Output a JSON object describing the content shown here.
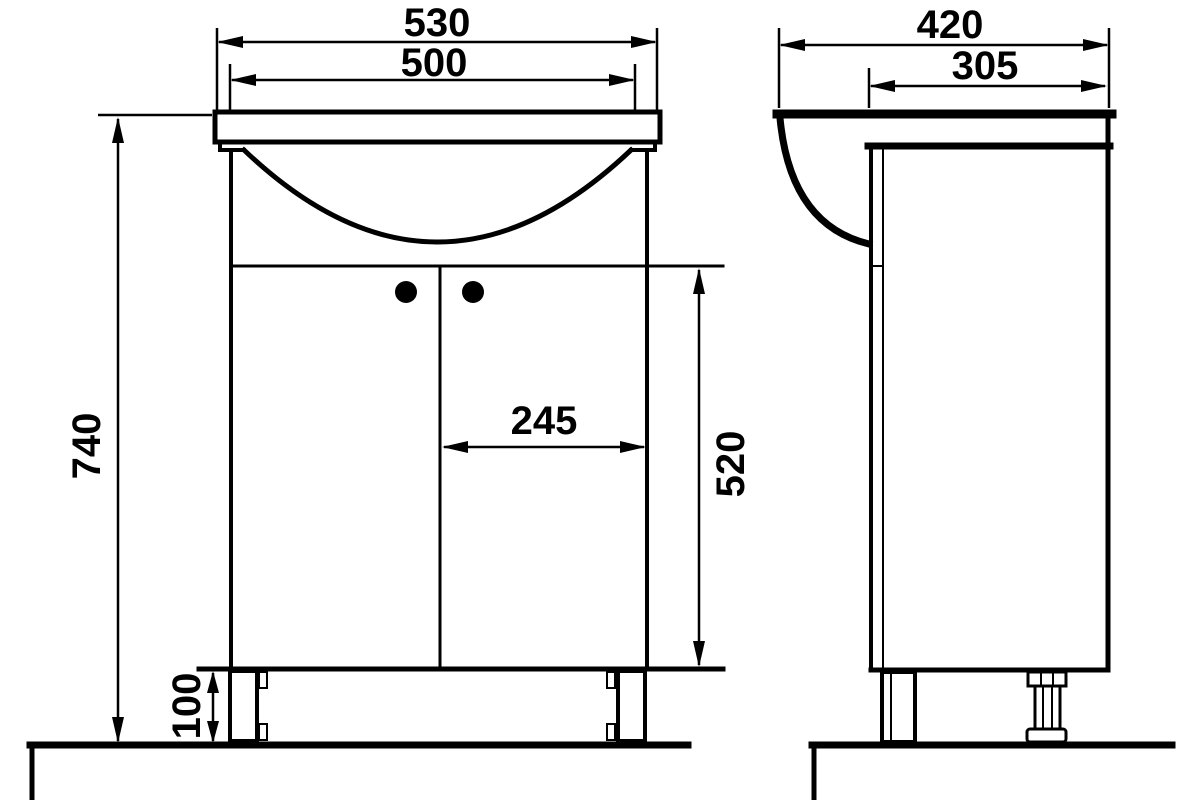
{
  "colors": {
    "line": "#000000",
    "background": "#ffffff"
  },
  "front_view": {
    "dim_overall_width": "530",
    "dim_basin_width": "500",
    "dim_overall_height": "740",
    "dim_door_width": "245",
    "dim_door_height": "520",
    "dim_plinth_height": "100"
  },
  "side_view": {
    "dim_overall_depth": "420",
    "dim_cabinet_depth": "305"
  }
}
